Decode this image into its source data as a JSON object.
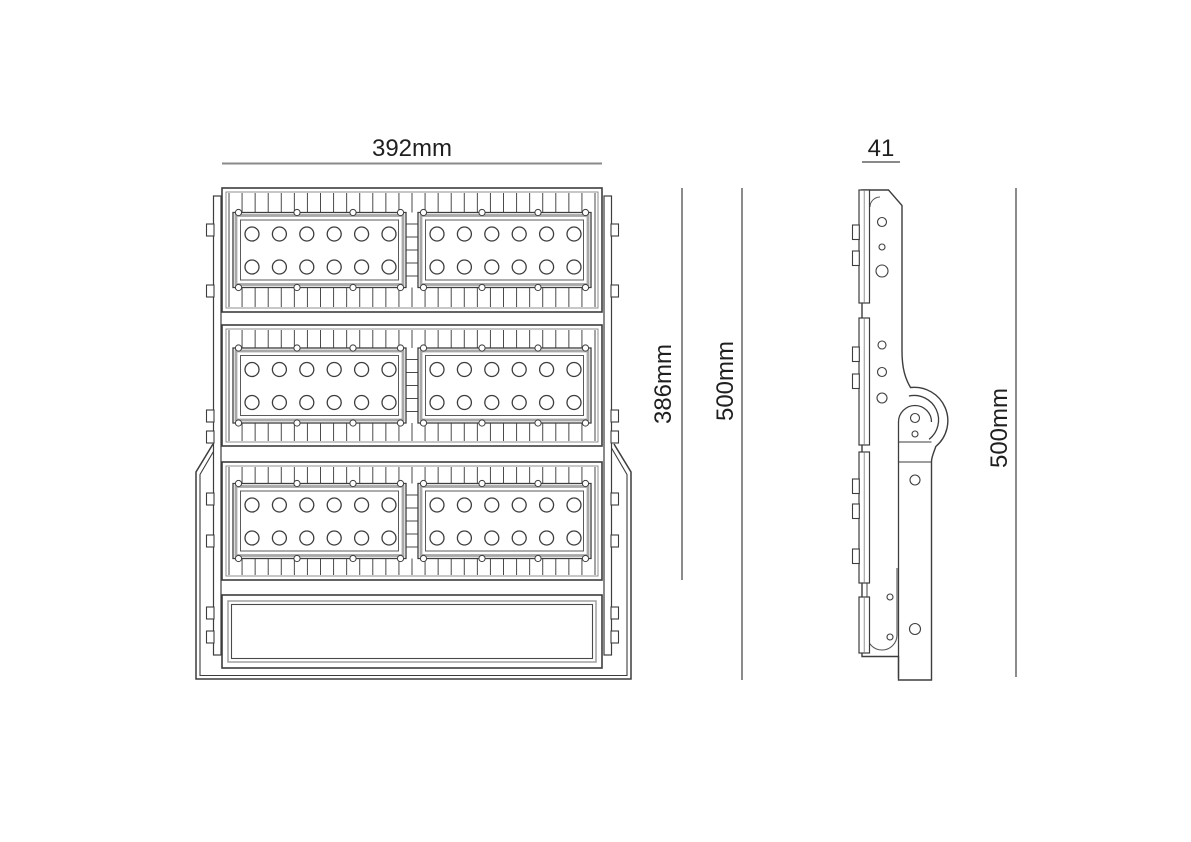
{
  "title": "LED floodlight dimensioned technical drawing",
  "colors": {
    "background": "#ffffff",
    "line": "#3d3d3d",
    "line_medium": "#5a5a5a",
    "line_light": "#a8a8a8",
    "dim_line": "#8a8a8a",
    "text": "#1f1f1f"
  },
  "front_view": {
    "name": "front view",
    "width_dimension": {
      "label": "392mm"
    },
    "module_stack_dimension": {
      "label": "386mm"
    },
    "overall_height_dimension": {
      "label": "500mm"
    },
    "modules": {
      "count": 3,
      "panels_per_module": 2,
      "led_rows_per_panel": 2,
      "led_columns_per_panel": 6,
      "leds_per_panel": 12,
      "total_leds": 72
    },
    "driver_compartment": true
  },
  "side_view": {
    "name": "side view",
    "depth_dimension": {
      "label": "41"
    },
    "overall_height_dimension": {
      "label": "500mm"
    }
  }
}
